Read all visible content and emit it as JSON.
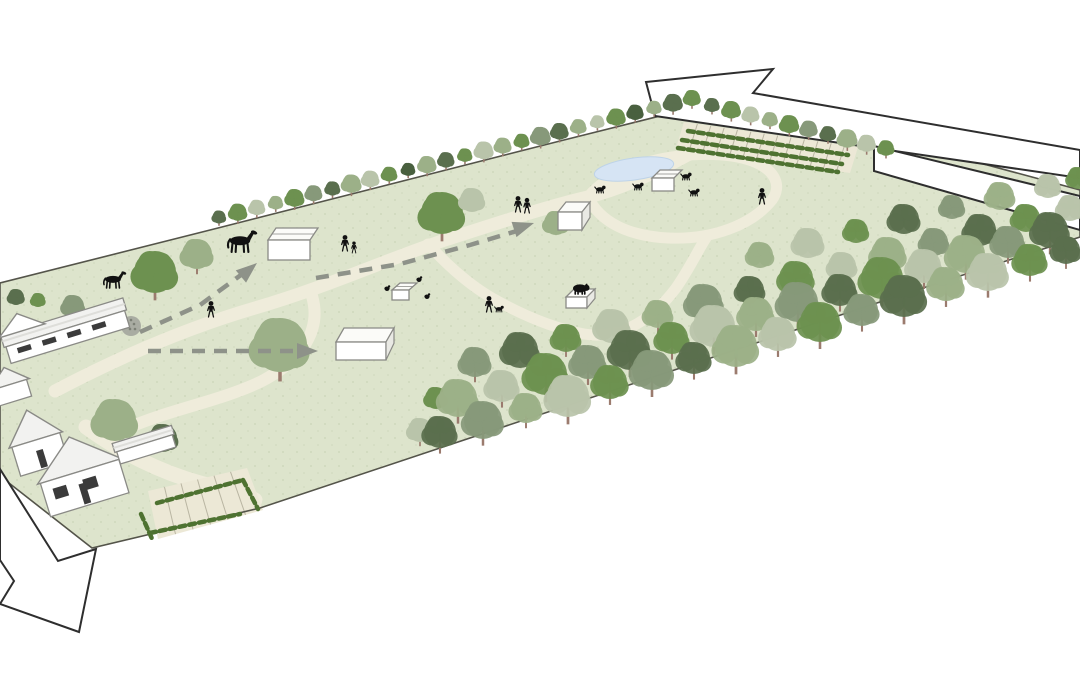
{
  "canvas": {
    "width": 1080,
    "height": 675,
    "background": "#ffffff"
  },
  "colors": {
    "grass": "#dde4cc",
    "grass_speckle": "#b7c4a2",
    "path": "#efecdb",
    "parking_surface": "#ece8d6",
    "bay_line": "#b9b5a2",
    "boundary": "#54544a",
    "pond_fill": "#d6e4f4",
    "pond_stroke": "#bed3e8",
    "arrow_fill": "#ffffff",
    "arrow_stroke": "#2e2e2e",
    "dash": "#8e9289",
    "hedge": "#4e7231",
    "trunk": "#9b7b6e",
    "building_wall": "#ffffff",
    "building_stroke": "#8a8a86",
    "roof_light": "#f2f2f0",
    "roof_shade": "#dededa",
    "window_dark": "#3b3b3b",
    "figure": "#111111",
    "dotted_tree_fill": "#a9aca2",
    "dotted_tree_dot": "#7c8076"
  },
  "tree_palette": [
    "#6d9150",
    "#9cb088",
    "#5a6f4e",
    "#b9c4aa",
    "#87997a",
    "#49603f"
  ],
  "site": {
    "outline": [
      [
        0,
        283
      ],
      [
        218,
        228
      ],
      [
        560,
        141
      ],
      [
        692,
        108
      ],
      [
        880,
        136
      ],
      [
        1080,
        190
      ],
      [
        1080,
        237
      ],
      [
        883,
        301
      ],
      [
        620,
        388
      ],
      [
        443,
        447
      ],
      [
        260,
        508
      ],
      [
        92,
        548
      ],
      [
        0,
        476
      ]
    ]
  },
  "pond": {
    "cx": 634,
    "cy": 169,
    "rx": 40,
    "ry": 11,
    "rot": -8
  },
  "paths": [
    {
      "id": "main-footpath",
      "d": "M 55,391 C 110,362 180,330 255,308 C 330,286 390,258 445,240 C 495,224 545,207 588,197 C 625,188 660,170 693,152",
      "w": 13
    },
    {
      "id": "parking-spur-footpath",
      "d": "M 693,152 C 730,146 770,152 812,163",
      "w": 12
    },
    {
      "id": "meadow-return-footpath",
      "d": "M 312,296 C 322,330 302,360 262,381 C 224,400 168,410 128,428",
      "w": 12
    },
    {
      "id": "pond-loop-footpath",
      "d": "M 588,197 C 600,222 628,236 668,238 C 712,240 752,225 772,200 C 782,186 776,170 752,161 C 724,151 678,153 645,163 C 620,171 600,182 588,197",
      "w": 11
    },
    {
      "id": "woodland-footpath",
      "d": "M 428,244 C 448,266 468,284 492,298 C 522,315 552,328 584,334 C 620,340 652,320 676,288 C 690,268 698,250 706,238",
      "w": 11
    },
    {
      "id": "driveway",
      "d": "M 86,427 C 120,452 160,472 200,483 C 225,490 245,494 255,500",
      "w": 15
    }
  ],
  "outline_arrows": [
    {
      "id": "exit-arrow-northeast",
      "points": [
        [
          646,
          82
        ],
        [
          773,
          69
        ],
        [
          753,
          93
        ],
        [
          1080,
          150
        ],
        [
          1080,
          178
        ],
        [
          655,
          116
        ]
      ]
    },
    {
      "id": "road-band-east",
      "points": [
        [
          874,
          146
        ],
        [
          1080,
          196
        ],
        [
          1080,
          230
        ],
        [
          874,
          171
        ]
      ]
    },
    {
      "id": "entry-arrow-southwest",
      "points": [
        [
          0,
          469
        ],
        [
          58,
          561
        ],
        [
          96,
          549
        ],
        [
          79,
          632
        ],
        [
          0,
          604
        ],
        [
          14,
          581
        ],
        [
          0,
          560
        ]
      ]
    }
  ],
  "dashed_routes": [
    {
      "id": "route-to-stable",
      "points": [
        [
          140,
          332
        ],
        [
          200,
          305
        ],
        [
          245,
          272
        ]
      ],
      "head": [
        257,
        263,
        -40
      ]
    },
    {
      "id": "route-to-shed",
      "points": [
        [
          316,
          278
        ],
        [
          400,
          264
        ],
        [
          470,
          245
        ],
        [
          520,
          230
        ]
      ],
      "head": [
        534,
        223,
        -18
      ]
    },
    {
      "id": "route-to-shelter",
      "points": [
        [
          148,
          351
        ],
        [
          230,
          351
        ],
        [
          302,
          351
        ]
      ],
      "head": [
        318,
        351,
        0
      ]
    }
  ],
  "hedgerows": [
    {
      "id": "north-boundary-trees",
      "from": [
        219,
        227
      ],
      "to": [
        692,
        108
      ],
      "count": 26,
      "rmin": 6.5,
      "rmax": 9.5
    },
    {
      "id": "carpark-boundary-trees",
      "from": [
        712,
        115
      ],
      "to": [
        886,
        158
      ],
      "count": 10,
      "rmin": 7,
      "rmax": 9.5
    }
  ],
  "parking_areas": [
    {
      "id": "car-park-north",
      "poly": [
        [
          684,
          122
        ],
        [
          858,
          147
        ],
        [
          850,
          173
        ],
        [
          676,
          148
        ]
      ],
      "bays": 12
    },
    {
      "id": "car-park-south",
      "poly": [
        [
          148,
          491
        ],
        [
          247,
          468
        ],
        [
          263,
          510
        ],
        [
          158,
          539
        ]
      ],
      "bays": 5
    }
  ],
  "hedge_lines": [
    {
      "pts": [
        [
          688,
          131
        ],
        [
          848,
          155
        ]
      ]
    },
    {
      "pts": [
        [
          682,
          140
        ],
        [
          842,
          164
        ]
      ]
    },
    {
      "pts": [
        [
          678,
          148
        ],
        [
          838,
          172
        ]
      ]
    },
    {
      "pts": [
        [
          157,
          503
        ],
        [
          243,
          480
        ]
      ]
    },
    {
      "pts": [
        [
          243,
          480
        ],
        [
          258,
          509
        ]
      ]
    },
    {
      "pts": [
        [
          150,
          533
        ],
        [
          240,
          514
        ]
      ]
    },
    {
      "pts": [
        [
          141,
          514
        ],
        [
          153,
          541
        ]
      ]
    }
  ],
  "trees_single": [
    [
      16,
      297,
      8,
      2,
      0
    ],
    [
      38,
      300,
      7,
      0,
      0
    ],
    [
      73,
      306,
      11,
      4,
      0
    ],
    [
      97,
      322,
      8,
      1,
      1
    ],
    [
      155,
      272,
      21,
      0,
      1
    ],
    [
      197,
      254,
      15,
      1,
      1
    ],
    [
      115,
      420,
      21,
      1,
      0
    ],
    [
      163,
      438,
      14,
      2,
      0
    ],
    [
      280,
      345,
      27,
      1,
      1
    ],
    [
      442,
      213,
      21,
      0,
      1
    ],
    [
      472,
      200,
      12,
      3,
      0
    ],
    [
      556,
      223,
      12,
      1,
      0
    ],
    [
      420,
      430,
      12,
      3,
      1
    ],
    [
      436,
      398,
      11,
      0,
      0
    ]
  ],
  "dotted_tree": {
    "x": 131,
    "y": 326,
    "r": 10
  },
  "woodland_rows": [
    [
      [
        760,
        255,
        13,
        1,
        0
      ],
      [
        808,
        243,
        15,
        3,
        0
      ],
      [
        856,
        231,
        12,
        0,
        0
      ],
      [
        904,
        219,
        15,
        2,
        0
      ],
      [
        952,
        207,
        12,
        4,
        0
      ],
      [
        1000,
        196,
        14,
        1,
        0
      ],
      [
        1048,
        186,
        12,
        3,
        0
      ],
      [
        1078,
        178,
        11,
        0,
        0
      ]
    ],
    [
      [
        475,
        362,
        15,
        4,
        1
      ],
      [
        520,
        350,
        18,
        2,
        0
      ],
      [
        566,
        338,
        14,
        0,
        1
      ],
      [
        612,
        326,
        17,
        3,
        0
      ],
      [
        658,
        314,
        14,
        1,
        1
      ],
      [
        704,
        302,
        18,
        4,
        0
      ],
      [
        750,
        290,
        14,
        2,
        1
      ],
      [
        796,
        278,
        17,
        0,
        0
      ],
      [
        842,
        266,
        14,
        3,
        1
      ],
      [
        888,
        254,
        17,
        1,
        0
      ],
      [
        934,
        242,
        14,
        4,
        1
      ],
      [
        980,
        230,
        16,
        2,
        0
      ],
      [
        1026,
        218,
        14,
        0,
        0
      ],
      [
        1070,
        208,
        13,
        3,
        0
      ]
    ],
    [
      [
        458,
        398,
        19,
        1,
        1
      ],
      [
        502,
        386,
        16,
        3,
        1
      ],
      [
        546,
        374,
        21,
        0,
        1
      ],
      [
        588,
        362,
        17,
        4,
        1
      ],
      [
        630,
        350,
        20,
        2,
        1
      ],
      [
        672,
        338,
        16,
        0,
        1
      ],
      [
        714,
        326,
        21,
        3,
        1
      ],
      [
        756,
        314,
        17,
        1,
        1
      ],
      [
        798,
        302,
        20,
        4,
        1
      ],
      [
        840,
        290,
        16,
        2,
        1
      ],
      [
        882,
        278,
        21,
        0,
        1
      ],
      [
        924,
        266,
        17,
        3,
        1
      ],
      [
        966,
        254,
        19,
        1,
        1
      ],
      [
        1008,
        242,
        16,
        4,
        1
      ],
      [
        1050,
        230,
        18,
        2,
        1
      ]
    ],
    [
      [
        440,
        432,
        16,
        2,
        1
      ],
      [
        483,
        420,
        19,
        4,
        1
      ],
      [
        526,
        408,
        15,
        1,
        1
      ],
      [
        568,
        396,
        21,
        3,
        1
      ],
      [
        610,
        382,
        17,
        0,
        1
      ],
      [
        652,
        370,
        20,
        4,
        1
      ],
      [
        694,
        358,
        16,
        2,
        1
      ],
      [
        736,
        346,
        21,
        1,
        1
      ],
      [
        778,
        334,
        17,
        3,
        1
      ],
      [
        820,
        322,
        20,
        0,
        1
      ],
      [
        862,
        310,
        16,
        4,
        1
      ],
      [
        904,
        296,
        21,
        2,
        1
      ],
      [
        946,
        284,
        17,
        1,
        1
      ],
      [
        988,
        272,
        19,
        3,
        1
      ],
      [
        1030,
        260,
        16,
        0,
        1
      ],
      [
        1066,
        250,
        14,
        2,
        1
      ]
    ]
  ],
  "buildings": [
    {
      "id": "barn-north",
      "x": 4,
      "y": 316,
      "w": 124,
      "h": 30,
      "rot": -17,
      "kind": "barn",
      "windows": 4
    },
    {
      "id": "cottage-west",
      "x": -8,
      "y": 372,
      "w": 36,
      "h": 30,
      "rot": -17,
      "kind": "house",
      "windows": 0
    },
    {
      "id": "farmhouse-small",
      "x": 12,
      "y": 418,
      "w": 50,
      "h": 52,
      "rot": -17,
      "kind": "house",
      "windows": 0,
      "door": 1
    },
    {
      "id": "farmhouse-main",
      "x": 40,
      "y": 446,
      "w": 82,
      "h": 60,
      "rot": -17,
      "kind": "house",
      "windows": 2,
      "door": 1
    },
    {
      "id": "outbuilding-row",
      "x": 116,
      "y": 434,
      "w": 58,
      "h": 22,
      "rot": -17,
      "kind": "shed",
      "windows": 0
    }
  ],
  "shelters": [
    {
      "id": "stable-shelter",
      "x": 268,
      "y": 240,
      "w": 42,
      "h": 20,
      "d": 12,
      "ridge": 1
    },
    {
      "id": "iso-shed",
      "x": 558,
      "y": 212,
      "w": 24,
      "h": 18,
      "d": 10,
      "cube": 1
    },
    {
      "id": "field-shelter",
      "x": 336,
      "y": 342,
      "w": 50,
      "h": 18,
      "d": 14,
      "cube": 1
    },
    {
      "id": "chicken-coop",
      "x": 392,
      "y": 290,
      "w": 17,
      "h": 10,
      "d": 7,
      "ridge": 1
    },
    {
      "id": "pig-ark",
      "x": 566,
      "y": 297,
      "w": 21,
      "h": 11,
      "d": 8,
      "cube": 1
    },
    {
      "id": "pond-shed",
      "x": 652,
      "y": 178,
      "w": 22,
      "h": 13,
      "d": 8,
      "ridge": 1
    }
  ],
  "figures": {
    "people": [
      [
        211,
        317,
        1
      ],
      [
        518,
        212,
        1
      ],
      [
        527,
        213,
        0.95
      ],
      [
        345,
        251,
        1
      ],
      [
        354,
        253,
        0.72
      ],
      [
        489,
        312,
        1
      ],
      [
        762,
        204,
        1
      ]
    ],
    "dogs": [
      [
        600,
        193,
        1
      ],
      [
        638,
        190,
        1
      ],
      [
        686,
        180,
        1
      ],
      [
        694,
        196,
        1
      ],
      [
        499,
        312,
        0.85
      ]
    ],
    "horses": [
      [
        240,
        252,
        1.5
      ],
      [
        113,
        288,
        1.15
      ]
    ],
    "chickens": [
      [
        387,
        291
      ],
      [
        419,
        282
      ],
      [
        427,
        299
      ]
    ],
    "pigs": [
      [
        580,
        294,
        1.4
      ]
    ]
  }
}
